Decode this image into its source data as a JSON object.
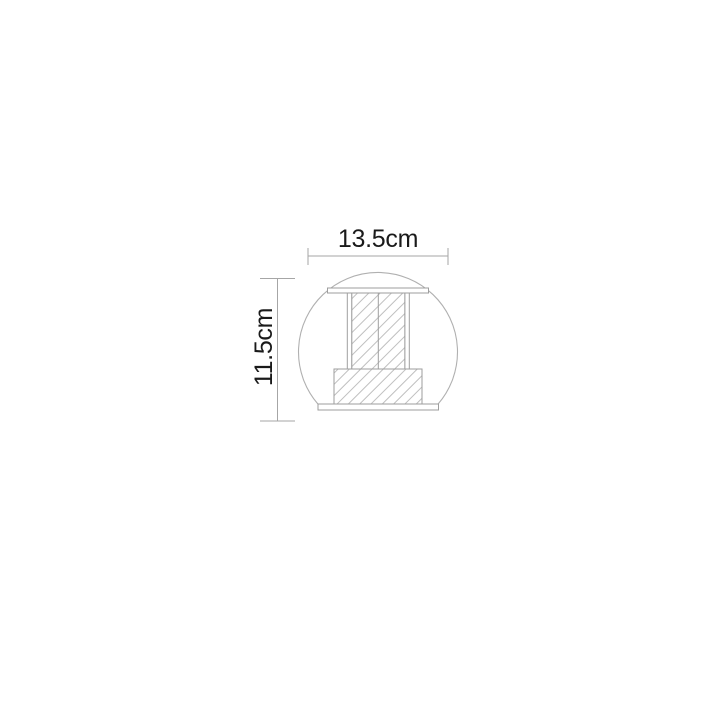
{
  "diagram": {
    "kind": "product-dimension-drawing",
    "width_label": "13.5cm",
    "height_label": "11.5cm",
    "colors": {
      "background": "#ffffff",
      "globe_outline": "#b0b0b0",
      "fixture_outline": "#9e9e9e",
      "hatch_line": "#bfbfbf",
      "dimension_line": "#a6a6a6",
      "label_text": "#1a1a1a"
    },
    "parts": [
      "globe-outline",
      "top-plate",
      "column-left-rail",
      "column-hatched-body",
      "column-center-divider",
      "column-right-rail",
      "base-block",
      "bottom-plate"
    ]
  }
}
